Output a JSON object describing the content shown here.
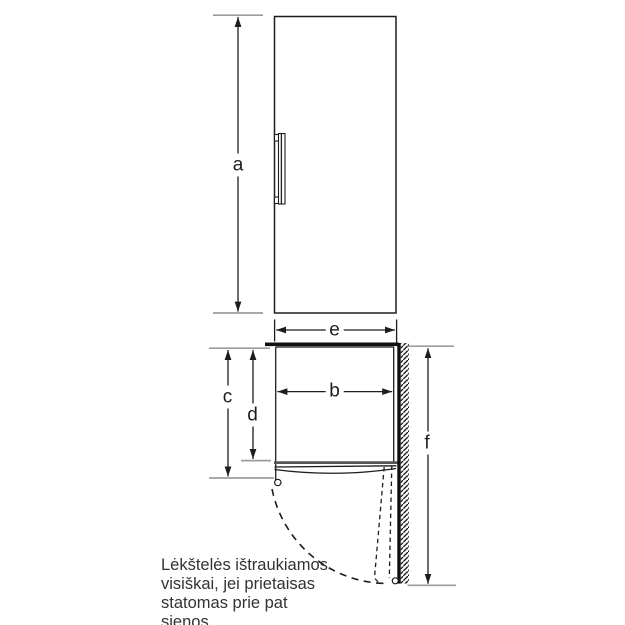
{
  "dimension_labels": {
    "a": "a",
    "b": "b",
    "c": "c",
    "d": "d",
    "e": "e",
    "f": "f"
  },
  "note": {
    "line1": "Lėkštelės ištraukiamos",
    "line2": "visiškai, jei prietaisas",
    "line3": "statomas prie pat",
    "line4": "sienos."
  },
  "colors": {
    "line": "#1d1d1d",
    "tick_gray": "#9d9d9d",
    "door_front_gray": "#565656",
    "wall_black": "#0f0f0f",
    "note_text": "#333333",
    "background": "#ffffff"
  }
}
